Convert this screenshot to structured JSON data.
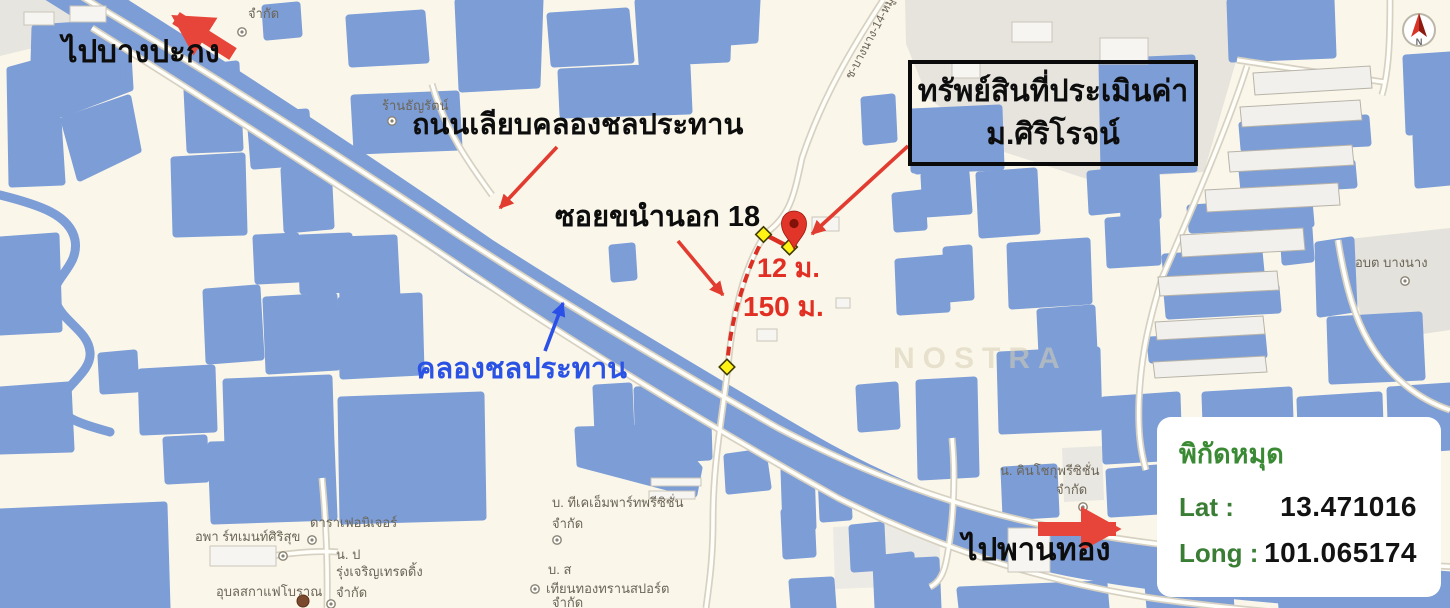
{
  "map": {
    "big_labels": {
      "to_bangpakong": "ไปบางปะกง",
      "road_canal": "ถนนเลียบคลองชลประทาน",
      "soi": "ซอยขนำนอก 18",
      "canal": "คลองชลประทาน",
      "to_phanthong": "ไปพานทอง",
      "dist_12": "12 ม.",
      "dist_150": "150 ม."
    },
    "property_box": {
      "line1": "ทรัพย์สินที่ประเมินค่า",
      "line2": "ม.ศิริโรจน์"
    },
    "coords_panel": {
      "title": "พิกัดหมุด",
      "lat_label": "Lat :",
      "lat_value": "13.471016",
      "long_label": "Long :",
      "long_value": "101.065174"
    },
    "poi": {
      "company_top": "จำกัด",
      "thanyarat": "ร้านธัญรัตน์",
      "apartment": "อพา ร์ทเมนท์ศิริสุข",
      "dara_furniture": "ดาราเฟอนิเจอร์",
      "n_p": "น. ป",
      "rung_trading": "รุ่งเจริญเทรดดิ้ง",
      "rung_trading2": "จำกัด",
      "ubon_coffee": "อุบลสกาแฟโบราณ",
      "tkm_parts": "บ. ทีเคเอ็มพาร์ทพรีซิชั่น",
      "tkm_parts2": "จำกัด",
      "b_s": "บ. ส",
      "thianthong": "เทียนทองทรานสปอร์ต",
      "thianthong2": "จำกัด",
      "kinshoku": "น. คินโชกุพรีซิชั่น",
      "kinshoku2": "จำกัด",
      "obt_bangnang": "อบต บางนาง",
      "road_name": "ช-บางนาง-14-หมู่ 9",
      "watermark": "NOSTRA"
    },
    "compass": {
      "n": "N"
    },
    "colors": {
      "pond_blue": "#7d9dd6",
      "annotation_red": "#e23b30",
      "label_blue": "#2a52e4",
      "panel_green": "#3a8a34",
      "marker_yellow": "#fff215"
    }
  }
}
